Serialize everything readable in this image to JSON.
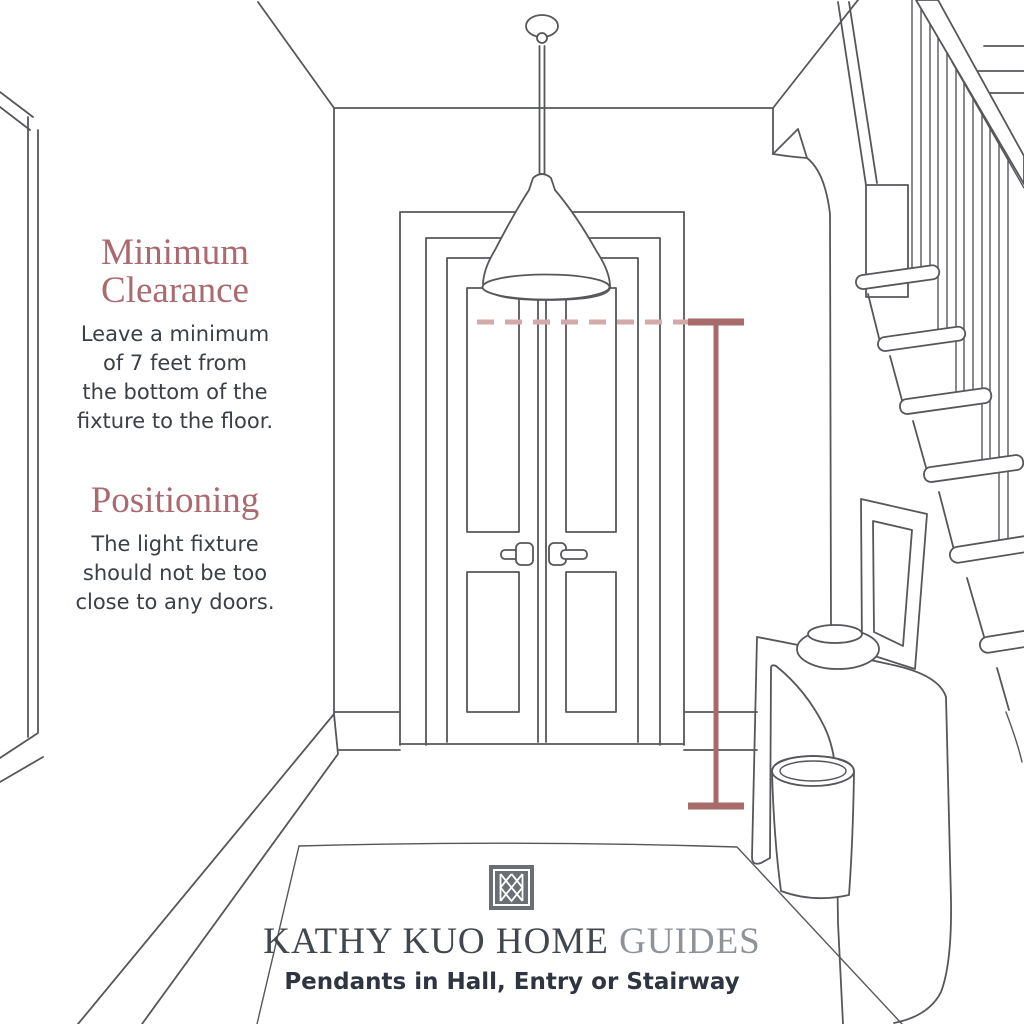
{
  "colors": {
    "page_bg": "#ffffff",
    "line_art": "#56575b",
    "heading": "#aa6a70",
    "body_text": "#3b4046",
    "brand_main_color": "#42474e",
    "brand_suffix_color": "#8f9398",
    "tagline_color": "#2f3540",
    "annotation_solid": "#a86b6b",
    "annotation_dashed": "#d3a9a9",
    "logo_bg": "#6a6f75"
  },
  "left_panel": {
    "sections": [
      {
        "heading": "Minimum Clearance",
        "heading_lines": [
          "Minimum",
          "Clearance"
        ],
        "body_lines": [
          "Leave a minimum",
          "of 7 feet from",
          "the bottom of the",
          "fixture to the floor."
        ]
      },
      {
        "heading": "Positioning",
        "heading_lines": [
          "Positioning"
        ],
        "body_lines": [
          "The light fixture",
          "should not be too",
          "close to any doors."
        ]
      }
    ]
  },
  "footer": {
    "logo_name": "kathy-kuo-home-monogram",
    "brand_main": "KATHY KUO HOME",
    "brand_suffix": "GUIDES",
    "tagline": "Pendants in Hall, Entry or Stairway"
  },
  "illustration": {
    "description": "Hand-drawn entry hallway: pendant light hanging in front of double doors, staircase with banister on the right, waterfall console table with bowl, basket and leaning picture frame, rug on floor",
    "annotations": {
      "dashed_line": "bottom-of-fixture level",
      "measurement_bar": "minimum 7 ft clearance from fixture bottom to floor"
    }
  }
}
